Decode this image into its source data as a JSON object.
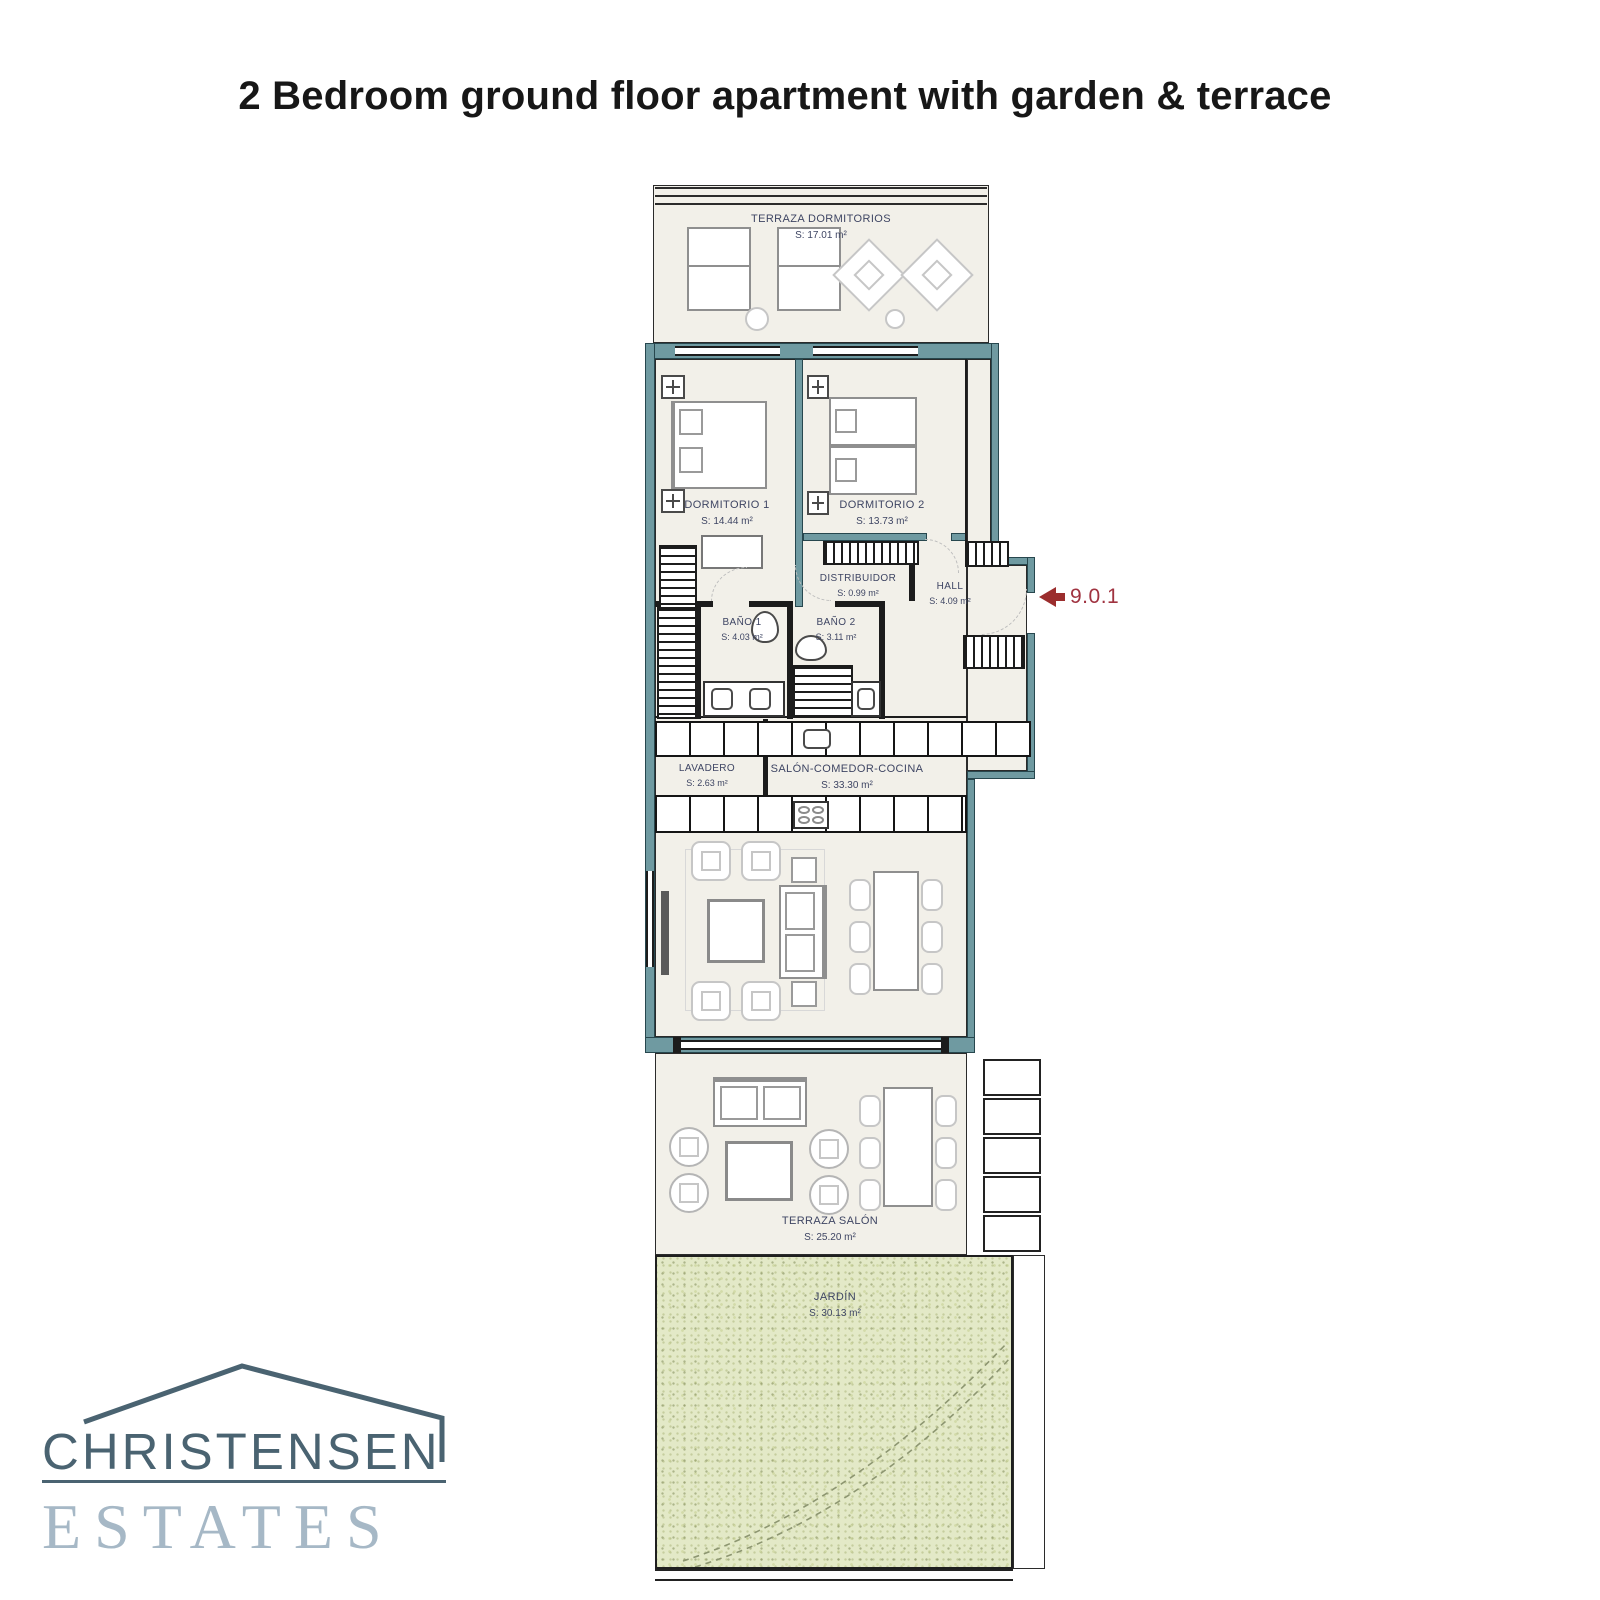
{
  "title": "2 Bedroom ground floor apartment with garden & terrace",
  "unit_ref": "9.0.1",
  "logo": {
    "line1": "CHRISTENSEN",
    "line2": "ESTATES"
  },
  "colors": {
    "wall_teal": "#6f9aa1",
    "floor_cream": "#f2f0e9",
    "garden_green": "#e3e9c7",
    "accent_red": "#9b2d2d",
    "label_ink": "#3e4563",
    "logo_dark": "#4a6371",
    "logo_light": "#a6b8c6"
  },
  "rooms": [
    {
      "id": "terraza-dormitorios",
      "name": "TERRAZA DORMITORIOS",
      "area": "S: 17.01 m²"
    },
    {
      "id": "dormitorio-1",
      "name": "DORMITORIO 1",
      "area": "S: 14.44 m²"
    },
    {
      "id": "dormitorio-2",
      "name": "DORMITORIO 2",
      "area": "S: 13.73 m²"
    },
    {
      "id": "distribuidor",
      "name": "DISTRIBUIDOR",
      "area": "S: 0.99 m²"
    },
    {
      "id": "hall",
      "name": "HALL",
      "area": "S: 4.09 m²"
    },
    {
      "id": "bano-1",
      "name": "BAÑO 1",
      "area": "S: 4.03 m²"
    },
    {
      "id": "bano-2",
      "name": "BAÑO 2",
      "area": "S: 3.11 m²"
    },
    {
      "id": "lavadero",
      "name": "LAVADERO",
      "area": "S: 2.63 m²"
    },
    {
      "id": "salon-comedor-cocina",
      "name": "SALÓN-COMEDOR-COCINA",
      "area": "S: 33.30 m²"
    },
    {
      "id": "terraza-salon",
      "name": "TERRAZA SALÓN",
      "area": "S: 25.20 m²"
    },
    {
      "id": "jardin",
      "name": "JARDÍN",
      "area": "S: 30.13 m²"
    }
  ]
}
